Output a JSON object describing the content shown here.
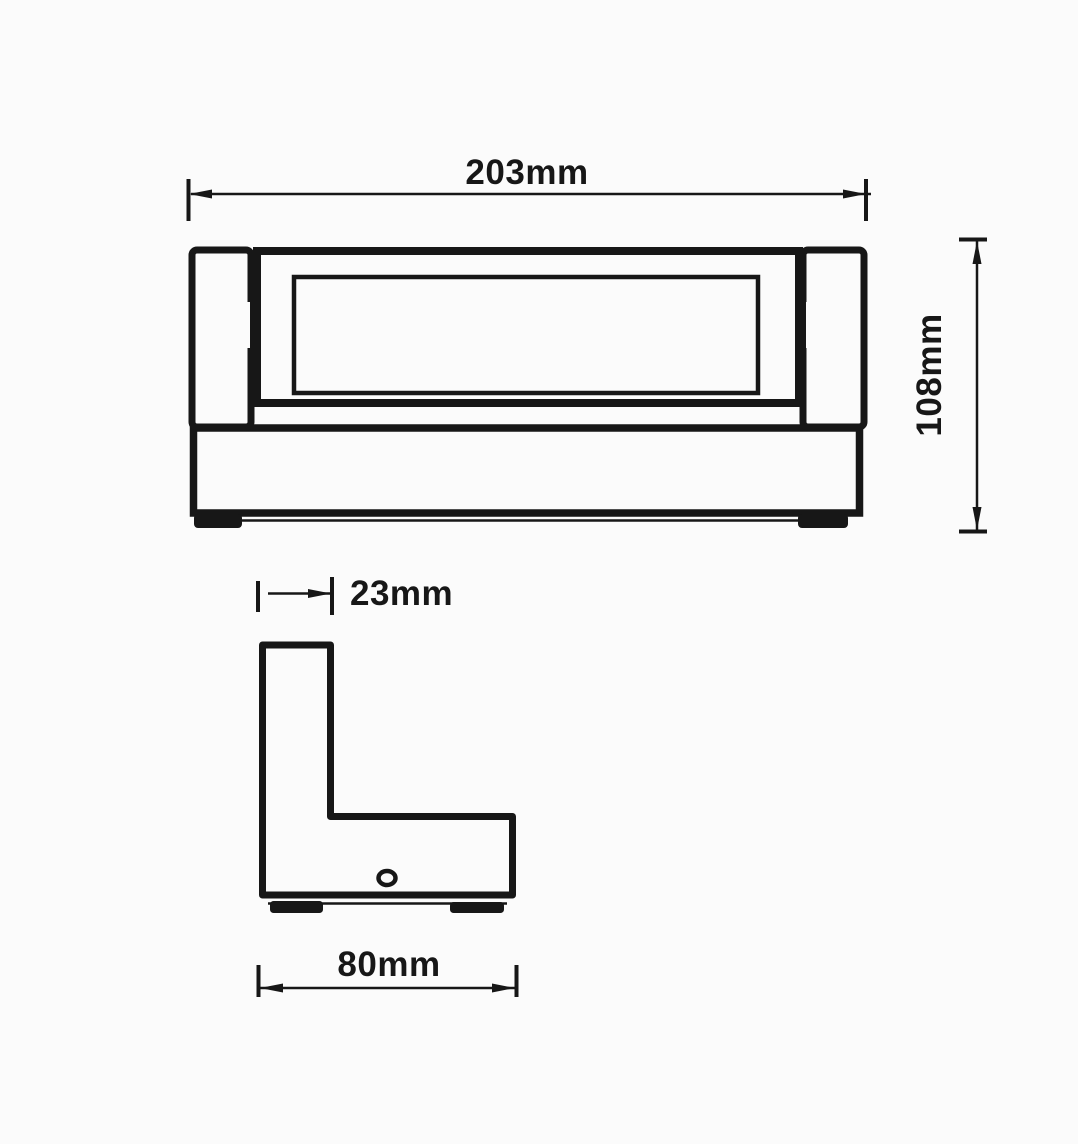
{
  "drawing": {
    "kind": "technical-dimension-drawing",
    "front_view": {
      "width": {
        "label": "203mm",
        "value_mm": 203
      },
      "height": {
        "label": "108mm",
        "value_mm": 108
      }
    },
    "side_view": {
      "arm_width": {
        "label": "23mm",
        "value_mm": 23
      },
      "depth": {
        "label": "80mm",
        "value_mm": 80
      }
    }
  },
  "colors": {
    "line": "#171717",
    "background": "#fbfbfb"
  }
}
